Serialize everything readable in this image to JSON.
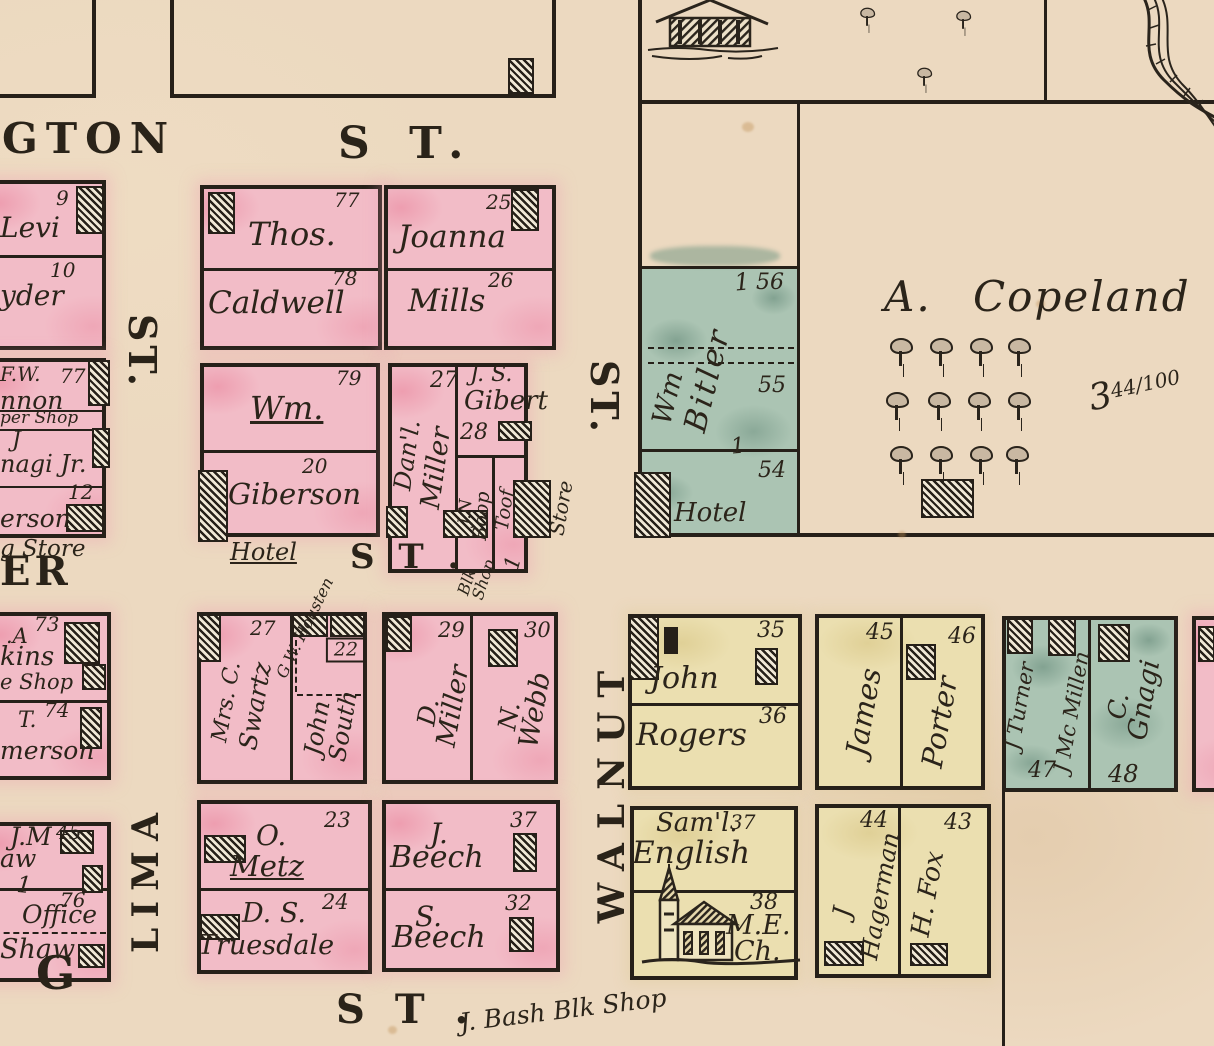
{
  "colors": {
    "paper": "#ecd9c0",
    "pink": "#f2bcc7",
    "yellow": "#ebdfb0",
    "teal": "#abc4b3",
    "ink": "#262019"
  },
  "streets": {
    "washington_fragment": "GTON",
    "st_top": "S T.",
    "st_left_vertical": "ST.",
    "st_right_vertical": "ST.",
    "er_fragment": "ER",
    "st_middle": "S T .",
    "walnut": "WALNUT",
    "lima": "LIMA",
    "g_fragment": "G",
    "st_bottom": "S T .",
    "bash_blacksmith": "J. Bash Blk Shop"
  },
  "annotations": {
    "store": "Store",
    "blk_shop": "Blk Shop",
    "blk_shop_mark": "1",
    "giberson_hotel": "Hotel",
    "bitler_hotel": "Hotel",
    "drug_store_fragment": "g Store",
    "cooper_shop_fragment": "per Shop",
    "shoe_shop_fragment": "e Shop",
    "office": "Office",
    "mark_56": "1",
    "mark_54": "1",
    "mark_shaw": "1"
  },
  "left_column": {
    "lot9_number": "9",
    "lot9_name": "Levi",
    "lot10_number": "10",
    "lot10_name": "yder",
    "lot77_number": "77",
    "lot77_initials": "F.W.",
    "lot77_name": "nnon",
    "gnagi_j": "J",
    "gnagi_name": "nagi Jr.",
    "lot12_number": "12",
    "lot12_name": "erson",
    "lot73_number": "73",
    "lot73_initials": ".A",
    "lot73_name": "kins",
    "lot74_number": "74",
    "lot74_initials": "T.",
    "lot74_name": "merson",
    "lot45_number": "45",
    "lot45_initials": "J.M",
    "lot45_name": "aw",
    "lot76_number": "76",
    "lot76_name": "Shaw"
  },
  "blocks": {
    "caldwell": {
      "lot77": "77",
      "first": "Thos.",
      "lot78": "78",
      "last": "Caldwell"
    },
    "mills": {
      "lot25": "25",
      "first": "Joanna",
      "lot26": "26",
      "last": "Mills"
    },
    "giberson": {
      "lot79": "79",
      "first": "Wm.",
      "lot20": "20",
      "last": "Giberson"
    },
    "miller": {
      "lot27": "27",
      "first": "Dan'l.",
      "last": "Miller"
    },
    "gibert": {
      "initials": "J. S.",
      "last": "Gibert",
      "lot28": "28"
    },
    "boop": {
      "initials": "J.N",
      "last": "Boop"
    },
    "toof": {
      "name": "Toof"
    },
    "bitler": {
      "first": "Wm",
      "last": "Bitler",
      "lot56": "56",
      "lot55": "55",
      "lot54": "54"
    },
    "copeland": {
      "name": "A. Copeland",
      "acres_whole": "3",
      "acres_fraction": "44/100"
    },
    "swartz": {
      "lot27": "27",
      "first": "Mrs. C.",
      "last": "Swartz"
    },
    "south": {
      "lot22": "22",
      "neighbor": "G.W. Housten",
      "first": "John",
      "last": "South"
    },
    "dmiller": {
      "lot29": "29",
      "first": "D.",
      "last": "Miller"
    },
    "webb": {
      "lot30": "30",
      "first": "N.",
      "last": "Webb"
    },
    "metz": {
      "lot23": "23",
      "first": "O.",
      "last": "Metz"
    },
    "truesdale": {
      "lot24": "24",
      "first": "D. S.",
      "last": "Truesdale"
    },
    "jbeech": {
      "lot37": "37",
      "first": "J.",
      "last": "Beech"
    },
    "sbeech": {
      "lot32": "32",
      "first": "S.",
      "last": "Beech"
    },
    "rogers": {
      "lot35": "35",
      "first": "John",
      "lot36": "36",
      "last": "Rogers"
    },
    "porter": {
      "lot45": "45",
      "first": "James",
      "lot46": "46",
      "last": "Porter"
    },
    "english": {
      "first": "Sam'l.",
      "lot37": "37",
      "last": "English",
      "lot38": "38",
      "church_line1": "M.E.",
      "church_line2": "Ch."
    },
    "hagerman": {
      "lot44": "44",
      "first": "J",
      "last": "Hagerman"
    },
    "fox": {
      "lot43": "43",
      "name": "H. Fox"
    },
    "turner": {
      "name": "J Turner",
      "lot47": "47"
    },
    "mcmillen": {
      "name": "J Mc Millen"
    },
    "gnagi": {
      "first": "C.",
      "last": "Gnagi",
      "lot48": "48"
    }
  }
}
